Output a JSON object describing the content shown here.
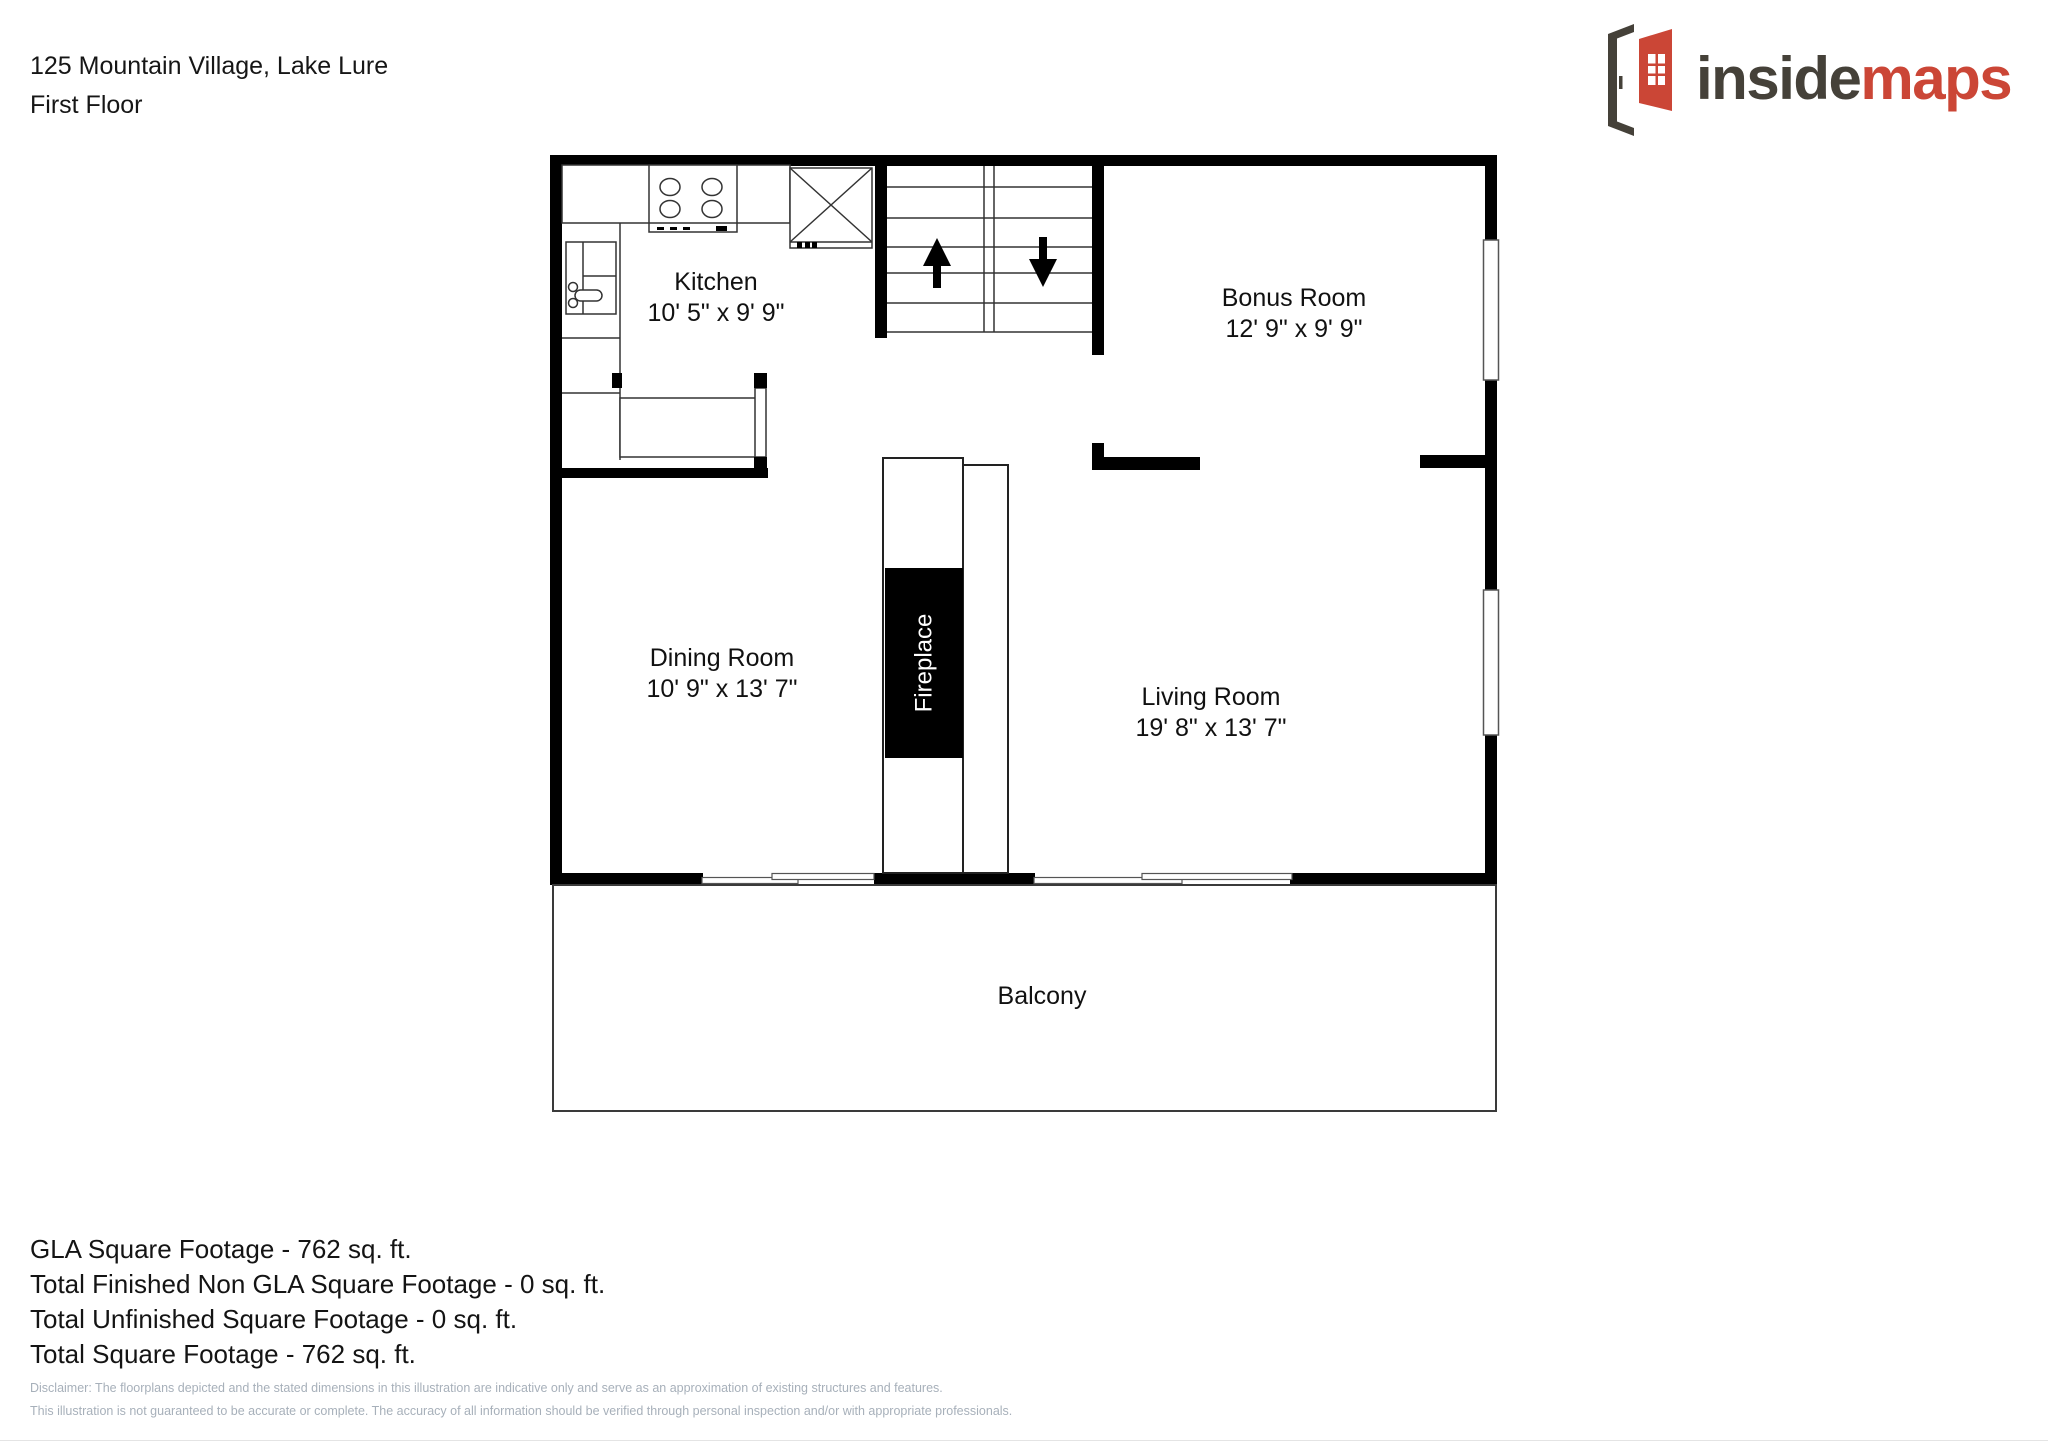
{
  "header": {
    "address": "125 Mountain Village, Lake Lure",
    "floor_label": "First Floor"
  },
  "logo": {
    "word_dark": "inside",
    "word_red": "maps",
    "icon": "open-door-icon",
    "dark_color": "#454139",
    "red_color": "#cb4636"
  },
  "floorplan": {
    "rooms": [
      {
        "name": "Kitchen",
        "dims": "10' 5\" x 9' 9\""
      },
      {
        "name": "Bonus Room",
        "dims": "12' 9\" x 9' 9\""
      },
      {
        "name": "Dining Room",
        "dims": "10' 9\" x 13' 7\""
      },
      {
        "name": "Living Room",
        "dims": "19' 8\" x 13' 7\""
      }
    ],
    "fireplace_label": "Fireplace",
    "balcony_label": "Balcony",
    "stairs": {
      "up_arrow": "up",
      "down_arrow": "down"
    }
  },
  "summary": {
    "line1": "GLA Square Footage - 762 sq. ft.",
    "line2": "Total Finished Non GLA Square Footage - 0 sq. ft.",
    "line3": "Total Unfinished Square Footage - 0 sq. ft.",
    "line4": "Total Square Footage - 762 sq. ft."
  },
  "disclaimer": {
    "line1": "Disclaimer: The floorplans depicted and the stated dimensions in this illustration are indicative only and serve as an approximation of existing structures and features.",
    "line2": "This illustration is not guaranteed to be accurate or complete. The accuracy of all information should be verified through personal inspection and/or with appropriate professionals."
  }
}
